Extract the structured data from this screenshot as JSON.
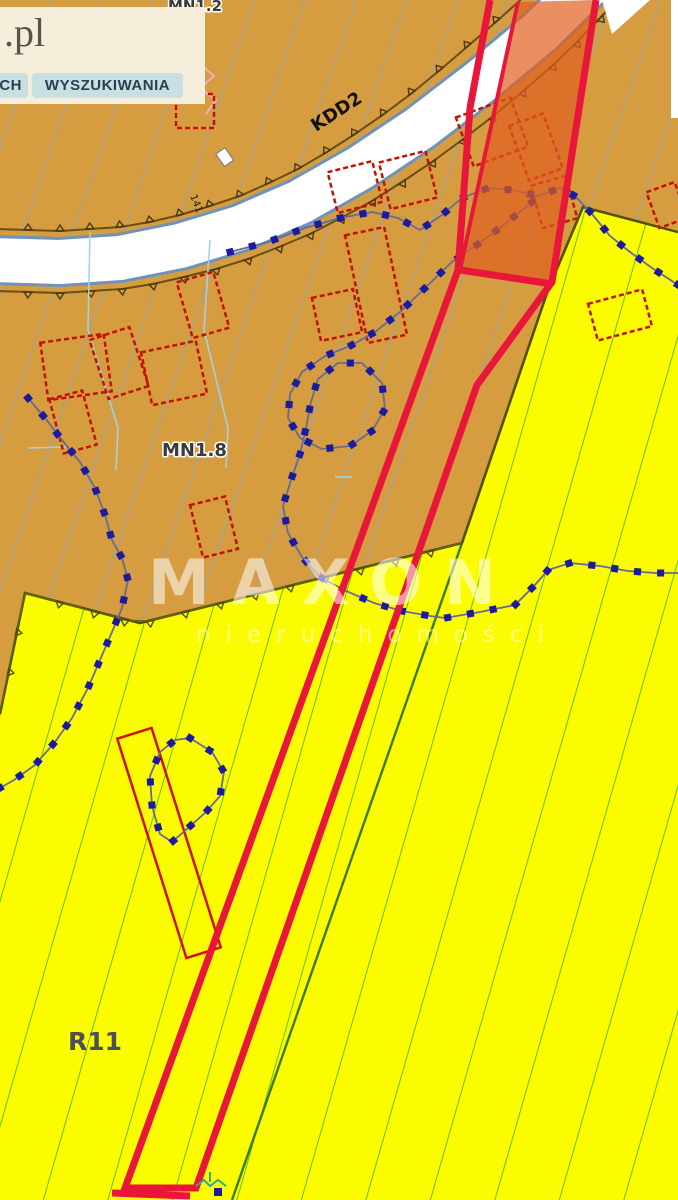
{
  "panel": {
    "logo_text": ".pl",
    "tabs": [
      {
        "label": "CH",
        "truncated": true
      },
      {
        "label": "WYSZUKIWANIA",
        "truncated": false
      }
    ]
  },
  "map": {
    "zone_labels": {
      "mn12": "MN1.2",
      "mn18": "MN1.8",
      "r11": "R11"
    },
    "road": {
      "label": "KDD2",
      "marker": "141"
    },
    "watermark": {
      "brand": "MAXON",
      "subtitle": "nieruchomości"
    },
    "colors": {
      "zone_mn": "#d69c40",
      "zone_r": "#fbfb02",
      "hatch_blue": "#86a8c6",
      "hatch_green": "#3fae2a",
      "road_fill": "#ffffff",
      "road_edge": "#6f93b8",
      "boundary_brown": "#6b4f12",
      "boundary_olive": "#51510a",
      "building_red": "#c41200",
      "dotted_blue": "#1b1b9e",
      "highlight_stroke": "#e8173a",
      "highlight_fill": "#e06020",
      "panel_bg": "#f4eedb",
      "tab_bg": "#c9dfe2"
    }
  }
}
